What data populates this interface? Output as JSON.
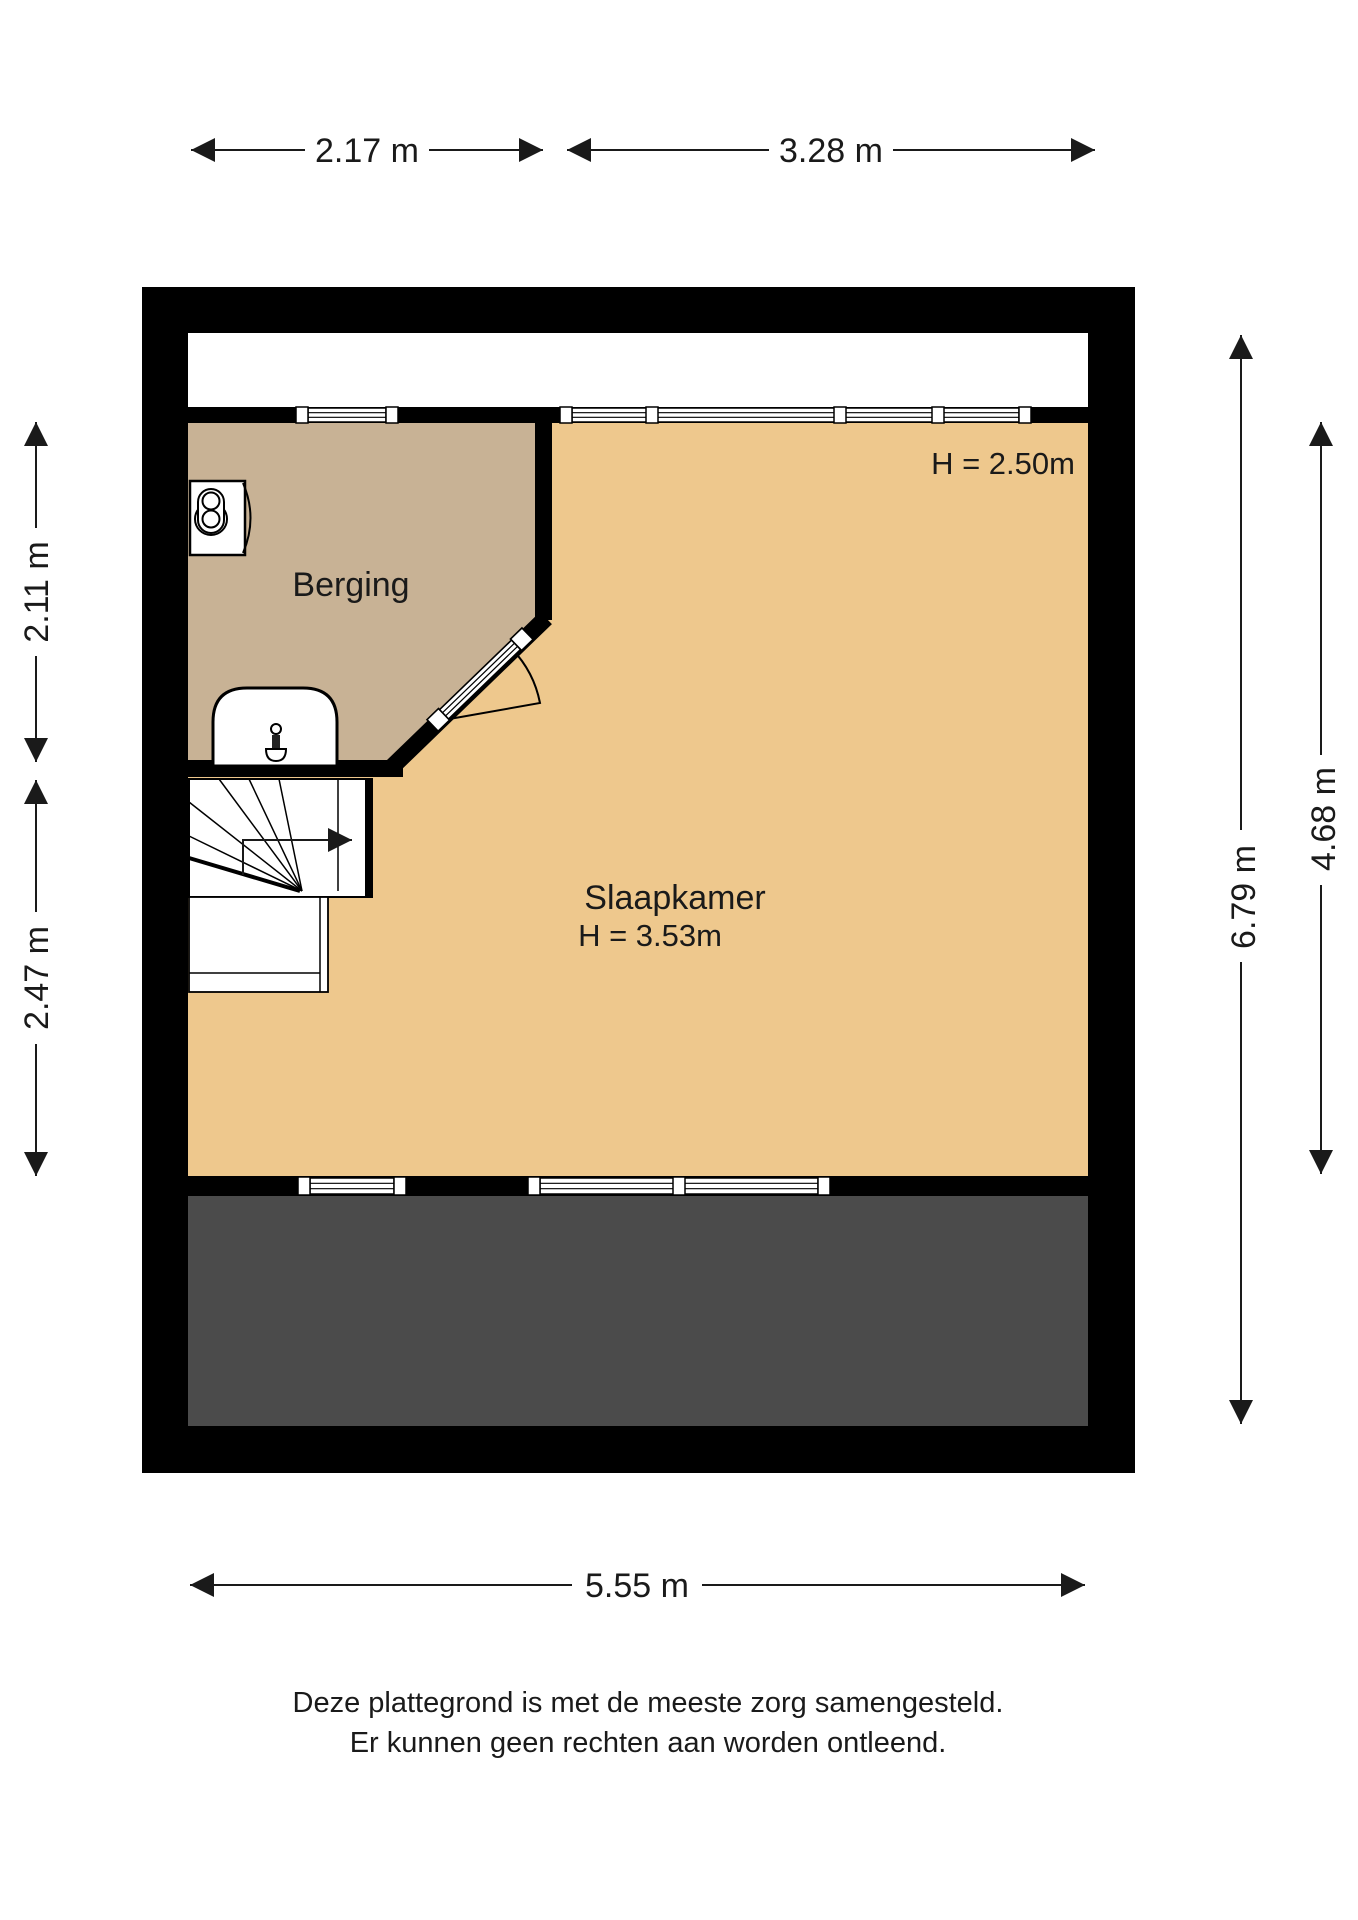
{
  "rooms": {
    "berging": {
      "label": "Berging"
    },
    "slaapkamer": {
      "label": "Slaapkamer",
      "height_center": "H = 3.53m",
      "height_right": "H = 2.50m"
    }
  },
  "dimensions": {
    "top_left": "2.17 m",
    "top_right": "3.28 m",
    "left_upper": "2.11 m",
    "left_lower": "2.47 m",
    "right_outer": "6.79 m",
    "right_inner": "4.68 m",
    "bottom": "5.55 m"
  },
  "disclaimer": {
    "line1": "Deze plattegrond is met de meeste zorg samengesteld.",
    "line2": "Er kunnen geen rechten aan worden ontleend."
  },
  "colors": {
    "wall": "#000000",
    "berging_floor": "#c8b295",
    "slaapkamer_floor": "#eec88d",
    "terrace": "#4b4b4b"
  }
}
